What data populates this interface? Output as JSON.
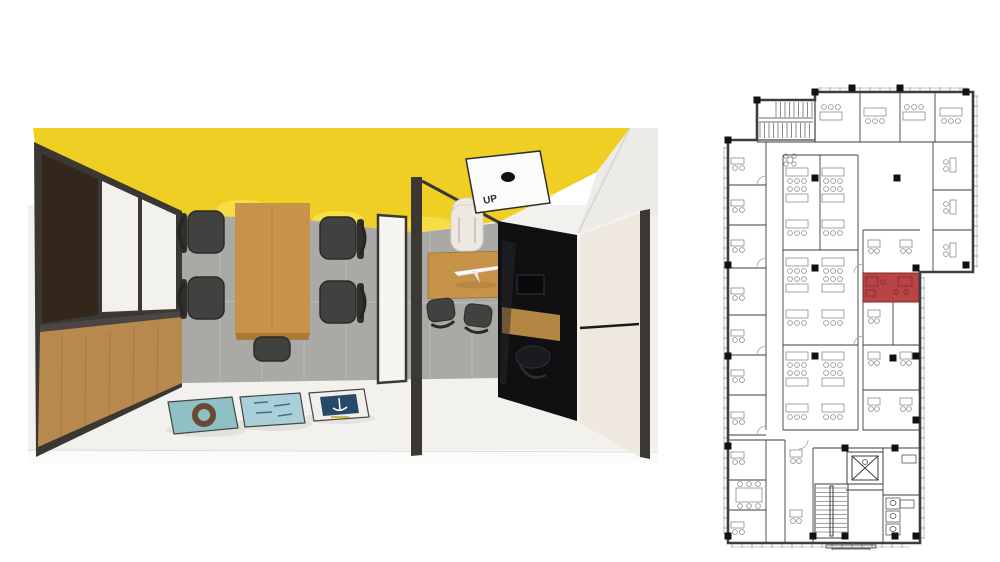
{
  "render": {
    "description": "top-down 3d render of office meeting room and manager office",
    "up_sign_label": "UP",
    "poster_count": 3,
    "meeting_chair_count": 5,
    "guest_chair_count": 2
  },
  "floorplan": {
    "description": "architectural office floor plan with highlighted room",
    "highlighted_room": {
      "x": 863,
      "y": 273,
      "w": 56,
      "h": 29
    },
    "walls": [
      [
        766,
        142,
        766,
        430
      ],
      [
        766,
        440,
        766,
        543
      ],
      [
        728,
        185,
        766,
        185
      ],
      [
        728,
        225,
        766,
        225
      ],
      [
        728,
        268,
        766,
        268
      ],
      [
        728,
        315,
        766,
        315
      ],
      [
        728,
        355,
        766,
        355
      ],
      [
        728,
        395,
        766,
        395
      ],
      [
        728,
        435,
        766,
        435
      ],
      [
        728,
        480,
        766,
        480
      ],
      [
        728,
        510,
        766,
        510
      ],
      [
        757,
        142,
        973,
        142
      ],
      [
        815,
        100,
        815,
        142
      ],
      [
        860,
        92,
        860,
        142
      ],
      [
        900,
        92,
        900,
        142
      ],
      [
        935,
        92,
        935,
        142
      ],
      [
        933,
        142,
        933,
        272
      ],
      [
        933,
        190,
        973,
        190
      ],
      [
        933,
        230,
        973,
        230
      ],
      [
        783,
        155,
        783,
        430
      ],
      [
        858,
        155,
        858,
        430
      ],
      [
        783,
        155,
        858,
        155
      ],
      [
        783,
        430,
        858,
        430
      ],
      [
        783,
        250,
        858,
        250
      ],
      [
        783,
        345,
        858,
        345
      ],
      [
        820,
        155,
        820,
        250
      ],
      [
        863,
        230,
        863,
        430
      ],
      [
        863,
        230,
        920,
        230
      ],
      [
        863,
        273,
        920,
        273
      ],
      [
        863,
        302,
        920,
        302
      ],
      [
        893,
        273,
        893,
        302
      ],
      [
        863,
        345,
        920,
        345
      ],
      [
        863,
        390,
        920,
        390
      ],
      [
        893,
        302,
        893,
        345
      ],
      [
        863,
        430,
        920,
        430
      ],
      [
        785,
        440,
        785,
        543
      ],
      [
        728,
        440,
        785,
        440
      ],
      [
        813,
        448,
        920,
        448
      ],
      [
        813,
        448,
        813,
        543
      ],
      [
        883,
        448,
        883,
        543
      ],
      [
        883,
        495,
        920,
        495
      ],
      [
        846,
        490,
        883,
        490
      ]
    ],
    "columns": [
      [
        728,
        140
      ],
      [
        757,
        100
      ],
      [
        815,
        92
      ],
      [
        852,
        88
      ],
      [
        900,
        88
      ],
      [
        966,
        92
      ],
      [
        966,
        265
      ],
      [
        916,
        268
      ],
      [
        916,
        356
      ],
      [
        916,
        420
      ],
      [
        916,
        536
      ],
      [
        728,
        536
      ],
      [
        728,
        265
      ],
      [
        728,
        356
      ],
      [
        728,
        446
      ],
      [
        815,
        178
      ],
      [
        897,
        178
      ],
      [
        815,
        268
      ],
      [
        815,
        356
      ],
      [
        893,
        358
      ],
      [
        845,
        448
      ],
      [
        895,
        448
      ],
      [
        813,
        536
      ],
      [
        845,
        536
      ],
      [
        895,
        536
      ]
    ],
    "windows": [
      {
        "o": "v",
        "x": 728,
        "y1": 148,
        "y2": 534,
        "d": -1
      },
      {
        "o": "v",
        "x": 973,
        "y1": 96,
        "y2": 268,
        "d": 1
      },
      {
        "o": "v",
        "x": 920,
        "y1": 278,
        "y2": 538,
        "d": 1
      },
      {
        "o": "h",
        "y": 92,
        "x1": 820,
        "x2": 968,
        "d": -1
      },
      {
        "o": "h",
        "y": 543,
        "x1": 732,
        "x2": 910,
        "d": 1
      }
    ],
    "desks": [
      {
        "x": 786,
        "y": 168,
        "t": "row",
        "f": 0
      },
      {
        "x": 822,
        "y": 168,
        "t": "row",
        "f": 0
      },
      {
        "x": 786,
        "y": 194,
        "t": "row",
        "f": 1
      },
      {
        "x": 822,
        "y": 194,
        "t": "row",
        "f": 1
      },
      {
        "x": 786,
        "y": 220,
        "t": "row",
        "f": 0
      },
      {
        "x": 822,
        "y": 220,
        "t": "row",
        "f": 0
      },
      {
        "x": 786,
        "y": 258,
        "t": "row",
        "f": 0
      },
      {
        "x": 822,
        "y": 258,
        "t": "row",
        "f": 0
      },
      {
        "x": 786,
        "y": 284,
        "t": "row",
        "f": 1
      },
      {
        "x": 822,
        "y": 284,
        "t": "row",
        "f": 1
      },
      {
        "x": 786,
        "y": 310,
        "t": "row",
        "f": 0
      },
      {
        "x": 822,
        "y": 310,
        "t": "row",
        "f": 0
      },
      {
        "x": 786,
        "y": 352,
        "t": "row",
        "f": 0
      },
      {
        "x": 822,
        "y": 352,
        "t": "row",
        "f": 0
      },
      {
        "x": 786,
        "y": 378,
        "t": "row",
        "f": 1
      },
      {
        "x": 822,
        "y": 378,
        "t": "row",
        "f": 1
      },
      {
        "x": 786,
        "y": 404,
        "t": "row",
        "f": 0
      },
      {
        "x": 822,
        "y": 404,
        "t": "row",
        "f": 0
      },
      {
        "x": 820,
        "y": 112,
        "t": "row",
        "f": 1
      },
      {
        "x": 864,
        "y": 108,
        "t": "row",
        "f": 0
      },
      {
        "x": 903,
        "y": 112,
        "t": "row",
        "f": 1
      },
      {
        "x": 940,
        "y": 108,
        "t": "row",
        "f": 0
      },
      {
        "x": 731,
        "y": 158,
        "t": "roomL"
      },
      {
        "x": 731,
        "y": 200,
        "t": "roomL"
      },
      {
        "x": 731,
        "y": 240,
        "t": "roomL"
      },
      {
        "x": 731,
        "y": 288,
        "t": "roomL"
      },
      {
        "x": 731,
        "y": 330,
        "t": "roomL"
      },
      {
        "x": 731,
        "y": 370,
        "t": "roomL"
      },
      {
        "x": 731,
        "y": 412,
        "t": "roomL"
      },
      {
        "x": 731,
        "y": 452,
        "t": "roomL"
      },
      {
        "x": 731,
        "y": 522,
        "t": "roomL"
      },
      {
        "x": 950,
        "y": 158,
        "t": "vert"
      },
      {
        "x": 950,
        "y": 200,
        "t": "vert"
      },
      {
        "x": 950,
        "y": 243,
        "t": "vert"
      },
      {
        "x": 868,
        "y": 240,
        "t": "roomS"
      },
      {
        "x": 900,
        "y": 240,
        "t": "roomS"
      },
      {
        "x": 868,
        "y": 310,
        "t": "roomS"
      },
      {
        "x": 868,
        "y": 352,
        "t": "roomS"
      },
      {
        "x": 900,
        "y": 352,
        "t": "roomS"
      },
      {
        "x": 868,
        "y": 398,
        "t": "roomS"
      },
      {
        "x": 900,
        "y": 398,
        "t": "roomS"
      },
      {
        "x": 736,
        "y": 488,
        "t": "meet"
      },
      {
        "x": 790,
        "y": 450,
        "t": "roomS"
      },
      {
        "x": 790,
        "y": 510,
        "t": "roomS"
      }
    ]
  },
  "colors": {
    "page_bg": "#ffffff",
    "ceiling_yellow": "#F0CF24",
    "ceiling_glow": "#F9E254",
    "wall_gray": "#A9A9A6",
    "wall_grout": "#C2C2BF",
    "floor_white": "#F2F1EE",
    "frame_dark": "#3B3834",
    "panel_white": "#F3F1EC",
    "glass_brown": "#33261B",
    "cabinet_wood": "#B8894E",
    "table_wood": "#C9924B",
    "table_wood_dark": "#A87A3A",
    "chair_dark": "#414140",
    "chair_dark_edge": "#2B2A28",
    "desk_wood": "#C79349",
    "chair_white": "#EDE9E0",
    "glass_black": "#101013",
    "cream_panel": "#EFE8DF",
    "bulkhead_white": "#ECEBE7",
    "poster_teal": "#8FC0C6",
    "poster_blue": "#A9CFD8",
    "poster_navy": "#274A6B",
    "plan_line": "#3E3E3E",
    "plan_furniture": "#8C8C8C",
    "plan_highlight": "#BA4345",
    "plan_highlight_line": "#7C2B2D",
    "plan_column": "#111111"
  }
}
